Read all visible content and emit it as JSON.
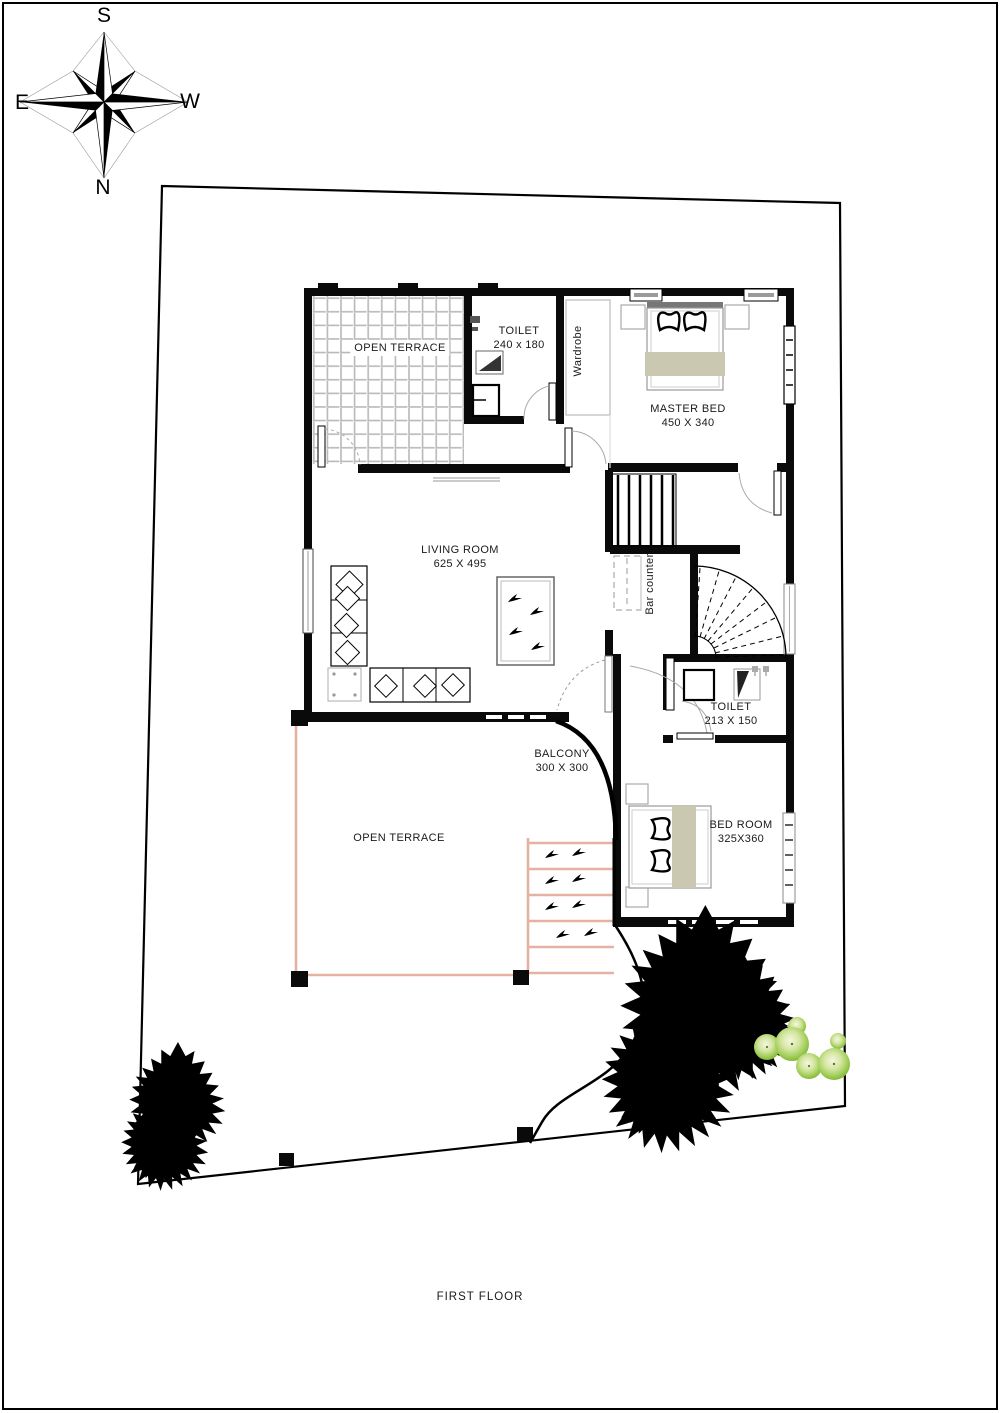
{
  "title_block": {
    "label": "FIRST FLOOR"
  },
  "compass": {
    "top": "S",
    "bottom": "N",
    "left": "E",
    "right": "W"
  },
  "rooms": {
    "open_terrace_top": {
      "name": "OPEN TERRACE"
    },
    "toilet_top": {
      "name": "TOILET",
      "dims": "240 x 180"
    },
    "wardrobe": {
      "name": "Wardrobe"
    },
    "master_bed": {
      "name": "MASTER BED",
      "dims": "450 X 340"
    },
    "living_room": {
      "name": "LIVING ROOM",
      "dims": "625 X 495"
    },
    "bar_counter": {
      "name": "Bar counter"
    },
    "toilet_mid": {
      "name": "TOILET",
      "dims": "213 X 150"
    },
    "balcony": {
      "name": "BALCONY",
      "dims": "300 X 300"
    },
    "bed_room": {
      "name": "BED ROOM",
      "dims": "325X360"
    },
    "open_terrace_bottom": {
      "name": "OPEN TERRACE"
    }
  },
  "colors": {
    "wall": "#0a0a0a",
    "terrace_outline": "#e3b2a1",
    "bed_accent": "#cbc8b2",
    "tile_line": "#b8b8b8",
    "bush_green": "#79af2b",
    "door_arc": "#999999"
  }
}
